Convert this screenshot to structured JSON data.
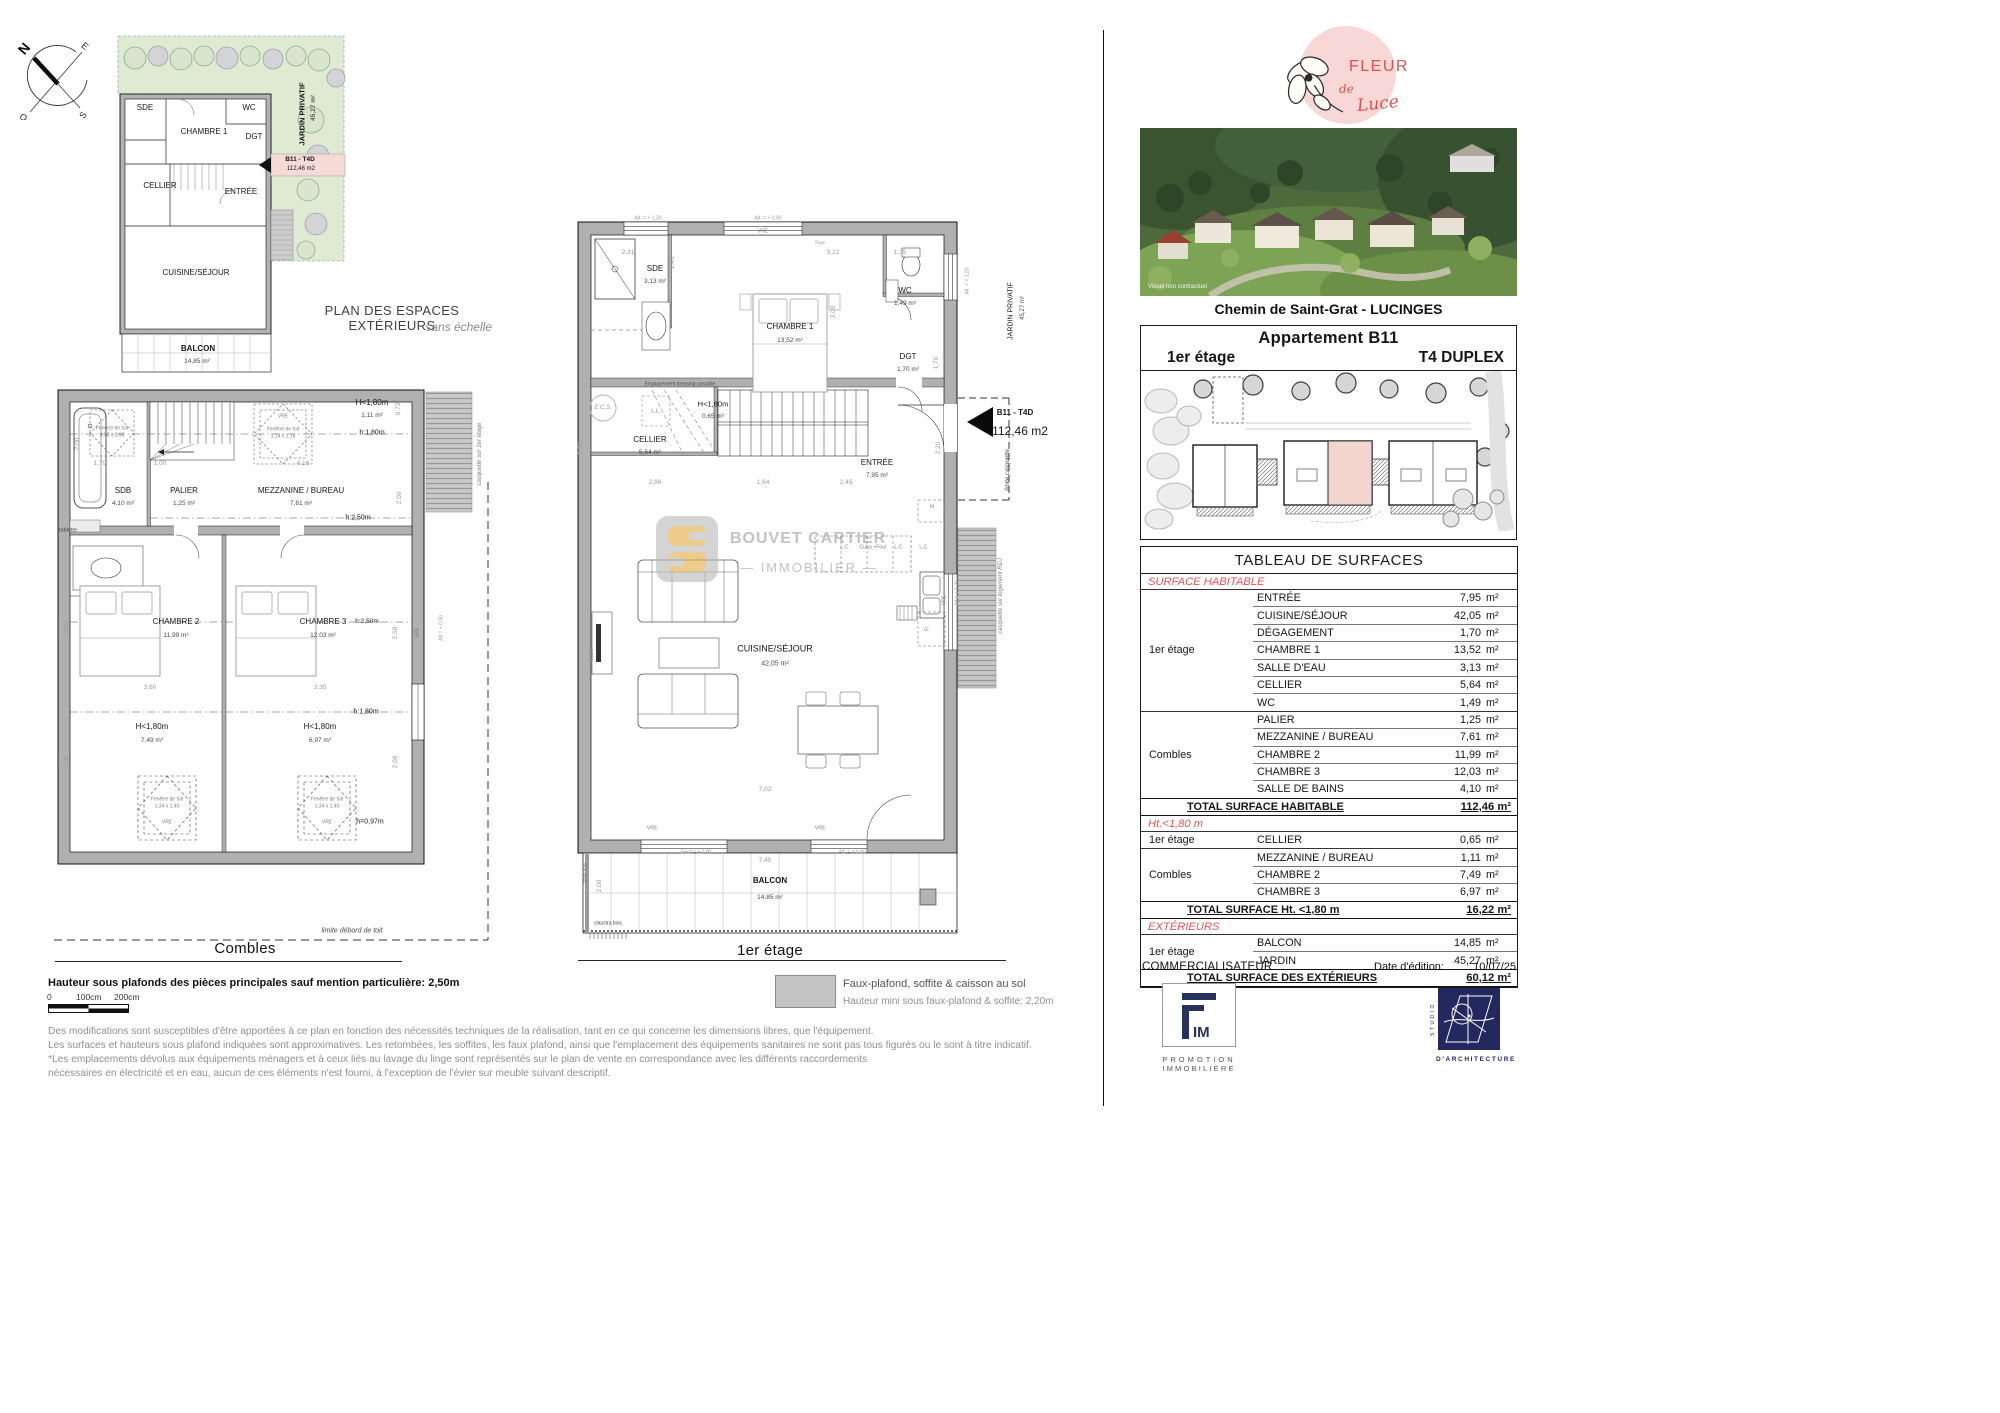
{
  "compass": {
    "n": "N",
    "e": "E",
    "s": "S",
    "o": "O"
  },
  "mini": {
    "caption": "PLAN DES ESPACES EXTÉRIEURS",
    "caption_sub": "sans échelle",
    "labels": [
      {
        "t": "SDE",
        "x": 37,
        "y": 80,
        "c": "s8"
      },
      {
        "t": "CHAMBRE 1",
        "x": 96,
        "y": 104,
        "c": "s8"
      },
      {
        "t": "WC",
        "x": 141,
        "y": 80,
        "c": "s8"
      },
      {
        "t": "DGT",
        "x": 146,
        "y": 109,
        "c": "s8"
      },
      {
        "t": "CELLIER",
        "x": 52,
        "y": 158,
        "c": "s8"
      },
      {
        "t": "ENTRÉE",
        "x": 133,
        "y": 164,
        "c": "s8"
      },
      {
        "t": "CUISINE/SÉJOUR",
        "x": 88,
        "y": 245,
        "c": "s8"
      },
      {
        "t": "BALCON",
        "x": 90,
        "y": 321,
        "c": "s8 b"
      },
      {
        "t": "14,85 m²",
        "x": 89,
        "y": 334,
        "c": "s65 c2"
      },
      {
        "t": "B11 - T4D",
        "x": 192,
        "y": 132,
        "c": "s65 b"
      },
      {
        "t": "112,46 m2",
        "x": 193,
        "y": 141,
        "c": "s6"
      },
      {
        "t": "JARDIN PRIVATIF",
        "x": 194,
        "y": 86,
        "c": "s75 b",
        "r": -90
      },
      {
        "t": "45,27 m²",
        "x": 206,
        "y": 80,
        "c": "s65",
        "r": -90
      }
    ]
  },
  "combles": {
    "caption": "Combles",
    "labels": [
      {
        "t": "H<1,80m",
        "x": 326,
        "y": 17,
        "c": "s8"
      },
      {
        "t": "1,11 m²",
        "x": 326,
        "y": 30,
        "c": "s65 c2"
      },
      {
        "t": "0,73",
        "x": 353,
        "y": 23,
        "c": "s65 c3",
        "r": -90
      },
      {
        "t": "h:1,80m",
        "x": 326,
        "y": 47,
        "c": "s7"
      },
      {
        "t": "Fenêtre de toit",
        "x": 66,
        "y": 43,
        "c": "s5 c4"
      },
      {
        "t": "0,78 x 0,98",
        "x": 66,
        "y": 50,
        "c": "s5 c4"
      },
      {
        "t": "VRE",
        "x": 237,
        "y": 31,
        "c": "s5 c4"
      },
      {
        "t": "Fenêtre de toit",
        "x": 237,
        "y": 44,
        "c": "s5 c4"
      },
      {
        "t": "1,14 x 1,18",
        "x": 237,
        "y": 51,
        "c": "s5 c4"
      },
      {
        "t": "2,00",
        "x": 32,
        "y": 58,
        "c": "s65 c3",
        "r": -90
      },
      {
        "t": "1,79",
        "x": 54,
        "y": 78,
        "c": "s65 c3"
      },
      {
        "t": "1,00",
        "x": 114,
        "y": 78,
        "c": "s65 c3"
      },
      {
        "t": "4,16",
        "x": 257,
        "y": 78,
        "c": "s65 c3"
      },
      {
        "t": "2,00",
        "x": 354,
        "y": 112,
        "c": "s65 c3",
        "r": -90
      },
      {
        "t": "SDB",
        "x": 77,
        "y": 105,
        "c": "s8"
      },
      {
        "t": "4,10 m²",
        "x": 77,
        "y": 118,
        "c": "s65 c2"
      },
      {
        "t": "PALIER",
        "x": 138,
        "y": 105,
        "c": "s8"
      },
      {
        "t": "1,25 m²",
        "x": 138,
        "y": 118,
        "c": "s65 c2"
      },
      {
        "t": "MEZZANINE / BUREAU",
        "x": 255,
        "y": 105,
        "c": "s8"
      },
      {
        "t": "7,61 m²",
        "x": 255,
        "y": 118,
        "c": "s65 c2"
      },
      {
        "t": "h:2,50m",
        "x": 312,
        "y": 132,
        "c": "s7"
      },
      {
        "t": "tablette",
        "x": 22,
        "y": 145,
        "c": "s55 c2"
      },
      {
        "t": "casquette sur 1er étage",
        "x": 434,
        "y": 68,
        "c": "s6 c4 i",
        "r": -90
      },
      {
        "t": "CHAMBRE 2",
        "x": 130,
        "y": 236,
        "c": "s8"
      },
      {
        "t": "11,99 m²",
        "x": 130,
        "y": 250,
        "c": "s65 c2"
      },
      {
        "t": "CHAMBRE 3",
        "x": 277,
        "y": 236,
        "c": "s8"
      },
      {
        "t": "12,03 m²",
        "x": 277,
        "y": 250,
        "c": "s65 c2"
      },
      {
        "t": "h:2,50m",
        "x": 321,
        "y": 236,
        "c": "s65"
      },
      {
        "t": "3,09",
        "x": 21,
        "y": 242,
        "c": "s65 c3",
        "r": -90
      },
      {
        "t": "2,59",
        "x": 350,
        "y": 247,
        "c": "s65 c3",
        "r": -90
      },
      {
        "t": "VRE",
        "x": 372,
        "y": 247,
        "c": "s5 c4",
        "r": -90
      },
      {
        "t": "Alt = + 0,90",
        "x": 396,
        "y": 242,
        "c": "s5 c3",
        "r": -90
      },
      {
        "t": "3,60",
        "x": 104,
        "y": 302,
        "c": "s65 c3"
      },
      {
        "t": "3,35",
        "x": 274,
        "y": 302,
        "c": "s65 c3"
      },
      {
        "t": "h:1,80m",
        "x": 320,
        "y": 326,
        "c": "s7"
      },
      {
        "t": "H<1,80m",
        "x": 106,
        "y": 341,
        "c": "s8"
      },
      {
        "t": "7,49 m²",
        "x": 106,
        "y": 355,
        "c": "s65 c2"
      },
      {
        "t": "H<1,80m",
        "x": 274,
        "y": 341,
        "c": "s8"
      },
      {
        "t": "6,97 m²",
        "x": 274,
        "y": 355,
        "c": "s65 c2"
      },
      {
        "t": "2,08",
        "x": 21,
        "y": 376,
        "c": "s65 c3",
        "r": -90
      },
      {
        "t": "2,08",
        "x": 350,
        "y": 376,
        "c": "s65 c3",
        "r": -90
      },
      {
        "t": "Fenêtre de toit",
        "x": 121,
        "y": 414,
        "c": "s5 c4"
      },
      {
        "t": "1,34 x 1,40",
        "x": 121,
        "y": 421,
        "c": "s5 c4"
      },
      {
        "t": "VRE",
        "x": 121,
        "y": 437,
        "c": "s5 c4"
      },
      {
        "t": "Fenêtre de toit",
        "x": 281,
        "y": 414,
        "c": "s5 c4"
      },
      {
        "t": "1,34 x 1,40",
        "x": 281,
        "y": 421,
        "c": "s5 c4"
      },
      {
        "t": "VRE",
        "x": 281,
        "y": 437,
        "c": "s5 c4"
      },
      {
        "t": "h=0,97m",
        "x": 324,
        "y": 436,
        "c": "s7"
      },
      {
        "t": "limite débord de toit",
        "x": 306,
        "y": 545,
        "c": "s7 c2 i"
      }
    ]
  },
  "etage": {
    "caption": "1er étage",
    "labels": [
      {
        "t": "Alt. = + 1,20",
        "x": 80,
        "y": 11,
        "c": "s5 c3"
      },
      {
        "t": "Alt. = + 0,90",
        "x": 200,
        "y": 11,
        "c": "s5 c3"
      },
      {
        "t": "VRE",
        "x": 195,
        "y": 24,
        "c": "s5 c4"
      },
      {
        "t": "Fixe",
        "x": 252,
        "y": 36,
        "c": "s5 c3"
      },
      {
        "t": "2,31",
        "x": 60,
        "y": 45,
        "c": "s65 c3"
      },
      {
        "t": "3,22",
        "x": 265,
        "y": 45,
        "c": "s65 c3"
      },
      {
        "t": "1,35",
        "x": 332,
        "y": 45,
        "c": "s65 c3"
      },
      {
        "t": "1,43",
        "x": 105,
        "y": 55,
        "c": "s65 c3",
        "r": -90
      },
      {
        "t": "SDE",
        "x": 87,
        "y": 61,
        "c": "s8"
      },
      {
        "t": "3,13 m²",
        "x": 87,
        "y": 74,
        "c": "s65 c2"
      },
      {
        "t": "CHAMBRE 1",
        "x": 222,
        "y": 119,
        "c": "s8"
      },
      {
        "t": "13,52 m²",
        "x": 222,
        "y": 133,
        "c": "s65 c2"
      },
      {
        "t": "3,00",
        "x": 266,
        "y": 104,
        "c": "s65 c3",
        "r": -90
      },
      {
        "t": "WC",
        "x": 337,
        "y": 83,
        "c": "s8"
      },
      {
        "t": "1,49 m²",
        "x": 337,
        "y": 96,
        "c": "s65 c2"
      },
      {
        "t": "DGT",
        "x": 340,
        "y": 149,
        "c": "s8"
      },
      {
        "t": "1,70 m²",
        "x": 340,
        "y": 162,
        "c": "s65 c2"
      },
      {
        "t": "1,70",
        "x": 369,
        "y": 155,
        "c": "s65 c3",
        "r": -90
      },
      {
        "t": "Alt. = + 1,20",
        "x": 400,
        "y": 73,
        "c": "s5 c3",
        "r": -90
      },
      {
        "t": "JARDIN PRIVATIF",
        "x": 443,
        "y": 103,
        "c": "s7",
        "r": -90
      },
      {
        "t": "45,27 m²",
        "x": 455,
        "y": 100,
        "c": "s6 c2",
        "r": -90
      },
      {
        "t": "Emplacement dressing possible",
        "x": 112,
        "y": 177,
        "c": "s5 c2"
      },
      {
        "t": "E.C.S.",
        "x": 35,
        "y": 200,
        "c": "s6 c3 i"
      },
      {
        "t": "L.L.",
        "x": 88,
        "y": 204,
        "c": "s55 c4"
      },
      {
        "t": "H<1,80m",
        "x": 145,
        "y": 196,
        "c": "s75"
      },
      {
        "t": "0,65 m²",
        "x": 145,
        "y": 209,
        "c": "s65 c2"
      },
      {
        "t": "CELLIER",
        "x": 82,
        "y": 232,
        "c": "s8"
      },
      {
        "t": "5,64 m²",
        "x": 82,
        "y": 245,
        "c": "s65 c2"
      },
      {
        "t": "2,20",
        "x": 13,
        "y": 240,
        "c": "s65 c3",
        "r": -90
      },
      {
        "t": "2,20",
        "x": 371,
        "y": 240,
        "c": "s65 c3",
        "r": -90
      },
      {
        "t": "ENTRÉE",
        "x": 309,
        "y": 255,
        "c": "s8"
      },
      {
        "t": "7,95 m²",
        "x": 309,
        "y": 268,
        "c": "s65 c2"
      },
      {
        "t": "2,86",
        "x": 87,
        "y": 275,
        "c": "s65 c3"
      },
      {
        "t": "1,64",
        "x": 195,
        "y": 275,
        "c": "s65 c3"
      },
      {
        "t": "2,45",
        "x": 278,
        "y": 275,
        "c": "s65 c3"
      },
      {
        "t": "B11 - T4D",
        "x": 447,
        "y": 205,
        "c": "s8 b"
      },
      {
        "t": "112,46 m2",
        "x": 452,
        "y": 223,
        "c": "s12"
      },
      {
        "t": "limite casquette",
        "x": 440,
        "y": 262,
        "c": "s6 c2 i",
        "r": -90
      },
      {
        "t": "Pl",
        "x": 364,
        "y": 300,
        "c": "s5 c4"
      },
      {
        "t": "L.C.",
        "x": 277,
        "y": 340,
        "c": "s5 c4"
      },
      {
        "t": "Cuiss.+Four",
        "x": 305,
        "y": 340,
        "c": "s5 c4"
      },
      {
        "t": "L.C.",
        "x": 331,
        "y": 340,
        "c": "s5 c4"
      },
      {
        "t": "L.C.",
        "x": 356,
        "y": 340,
        "c": "s5 c4"
      },
      {
        "t": "Fr.",
        "x": 360,
        "y": 420,
        "c": "s5 c4",
        "r": -90
      },
      {
        "t": "VRE",
        "x": 377,
        "y": 392,
        "c": "s5 c4",
        "r": -90
      },
      {
        "t": "Alt = + 1,20",
        "x": 390,
        "y": 385,
        "c": "s5 c3",
        "r": -90
      },
      {
        "t": "casquette sur logement RDJ",
        "x": 433,
        "y": 388,
        "c": "s6 c4 i",
        "r": -90
      },
      {
        "t": "CUISINE/SÉJOUR",
        "x": 207,
        "y": 441,
        "c": "s9"
      },
      {
        "t": "42,05 m²",
        "x": 207,
        "y": 456,
        "c": "s7 c2"
      },
      {
        "t": "6,20",
        "x": 24,
        "y": 447,
        "c": "s65 c3",
        "r": -90
      },
      {
        "t": "7,02",
        "x": 197,
        "y": 582,
        "c": "s65 c3"
      },
      {
        "t": "VRE",
        "x": 84,
        "y": 621,
        "c": "s5 c4"
      },
      {
        "t": "Seuil = ± 0,00",
        "x": 128,
        "y": 645,
        "c": "s5 c3"
      },
      {
        "t": "VRE",
        "x": 252,
        "y": 621,
        "c": "s5 c4"
      },
      {
        "t": "Alt. = ± 0,90",
        "x": 284,
        "y": 645,
        "c": "s5 c3"
      },
      {
        "t": "7,45",
        "x": 197,
        "y": 653,
        "c": "s65 c3"
      },
      {
        "t": "BALCON",
        "x": 202,
        "y": 673,
        "c": "s8 b"
      },
      {
        "t": "14,85 m²",
        "x": 202,
        "y": 690,
        "c": "s65 c2"
      },
      {
        "t": "2,00",
        "x": 32,
        "y": 678,
        "c": "s65 c3",
        "r": -90
      },
      {
        "t": "pare-vue",
        "x": 18,
        "y": 665,
        "c": "s5 c4",
        "r": -90
      },
      {
        "t": "claustra bois",
        "x": 40,
        "y": 716,
        "c": "s5 c2"
      }
    ]
  },
  "watermark": {
    "l1": "BOUVET CARTIER",
    "l2": "— IMMOBILIER —"
  },
  "right": {
    "logo": {
      "l1": "FLEUR",
      "l2": "de",
      "l3": "Luce"
    },
    "photo_caption": "Visuel non contractuel",
    "address": "Chemin de Saint-Grat - LUCINGES",
    "unit_box": {
      "title": "Appartement B11",
      "floor": "1er étage",
      "type": "T4 DUPLEX"
    },
    "surfaces": {
      "title": "TABLEAU DE SURFACES",
      "unit": "m²",
      "sections": [
        {
          "header": "SURFACE HABITABLE",
          "groups": [
            {
              "name": "1er étage",
              "rows": [
                [
                  "ENTRÉE",
                  "7,95"
                ],
                [
                  "CUISINE/SÉJOUR",
                  "42,05"
                ],
                [
                  "DÉGAGEMENT",
                  "1,70"
                ],
                [
                  "CHAMBRE 1",
                  "13,52"
                ],
                [
                  "SALLE D'EAU",
                  "3,13"
                ],
                [
                  "CELLIER",
                  "5,64"
                ],
                [
                  "WC",
                  "1,49"
                ]
              ]
            },
            {
              "name": "Combles",
              "rows": [
                [
                  "PALIER",
                  "1,25"
                ],
                [
                  "MEZZANINE / BUREAU",
                  "7,61"
                ],
                [
                  "CHAMBRE 2",
                  "11,99"
                ],
                [
                  "CHAMBRE 3",
                  "12,03"
                ],
                [
                  "SALLE DE BAINS",
                  "4,10"
                ]
              ]
            }
          ],
          "total": [
            "TOTAL SURFACE HABITABLE",
            "112,46 m²"
          ]
        },
        {
          "header": "Ht.<1,80 m",
          "groups": [
            {
              "name": "1er étage",
              "rows": [
                [
                  "CELLIER",
                  "0,65"
                ]
              ]
            },
            {
              "name": "Combles",
              "rows": [
                [
                  "MEZZANINE / BUREAU",
                  "1,11"
                ],
                [
                  "CHAMBRE 2",
                  "7,49"
                ],
                [
                  "CHAMBRE 3",
                  "6,97"
                ]
              ]
            }
          ],
          "total": [
            "TOTAL SURFACE Ht. <1,80 m",
            "16,22 m²"
          ]
        },
        {
          "header": "EXTÉRIEURS",
          "groups": [
            {
              "name": "1er étage",
              "rows": [
                [
                  "BALCON",
                  "14,85"
                ],
                [
                  "JARDIN",
                  "45,27"
                ]
              ]
            }
          ],
          "total": [
            "TOTAL SURFACE DES EXTÉRIEURS",
            "60,12 m²"
          ]
        }
      ]
    },
    "commercialisateur": "COMMERCIALISATEUR",
    "date_label": "Date d'édition:",
    "date_value": "10/07/25",
    "fim": {
      "name": "IM",
      "sub1": "PROMOTION",
      "sub2": "IMMOBILIÈRE"
    },
    "studio": {
      "vertical": "STUDIO",
      "bottom": "D'ARCHITECTURE"
    }
  },
  "footer": {
    "height_note": "Hauteur sous plafonds des pièces principales sauf mention particulière: 2,50m",
    "scale": {
      "t0": "0",
      "t100": "100cm",
      "t200": "200cm"
    },
    "legend": {
      "line1": "Faux-plafond, soffite & caisson au sol",
      "line2": "Hauteur mini sous faux-plafond & soffite: 2,20m"
    },
    "disclaimer": {
      "l1": "Des modifications sont susceptibles d'être apportées à ce plan en fonction des nécessités techniques de la réalisation, tant en ce qui concerne les dimensions libres, que l'équipement.",
      "l2": "Les surfaces et hauteurs sous plafond indiquées sont approximatives. Les retombées, les soffites, les faux plafond, ainsi que l'emplacement des équipements sanitaires ne sont pas tous figurés ou le sont à titre indicatif.",
      "l3": "*Les emplacements dévolus aux équipements ménagers et à ceux liés au lavage du linge sont représentés sur le plan de vente en correspondance avec les différents raccordements",
      "l4": "nécessaires en électricité et en eau, aucun de ces éléments n'est fourni, à l'exception de l'évier sur meuble suivant descriptif."
    }
  }
}
